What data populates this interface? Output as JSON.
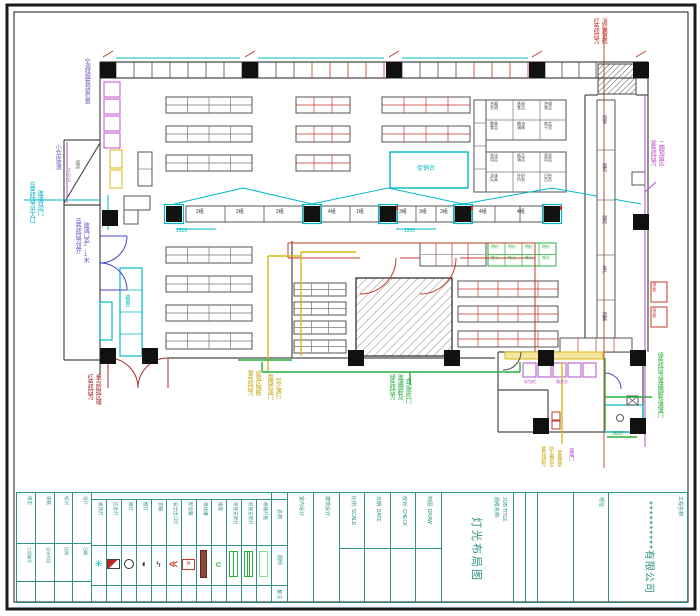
{
  "title_block": {
    "company": {
      "project_label": "工程名称:",
      "name": "**********有限公司"
    },
    "address_label": "地址:",
    "job": {
      "label": "图纸名称:",
      "label_en": "JOB TITLE",
      "title": "灯光布局图"
    },
    "fields": [
      "室内设计",
      "建筑设计",
      "比例: SCALE",
      "日期: DATE",
      "校对: CHECK",
      "制图: DRAW"
    ],
    "sign_table": {
      "cols": [
        {
          "top": "审定",
          "mid": "工程编号"
        },
        {
          "top": "审核",
          "mid": "设计阶段"
        },
        {
          "top": "校对",
          "mid": "比例"
        },
        {
          "top": "设计",
          "mid": "日期"
        }
      ]
    },
    "legend": {
      "headers": {
        "col_name": "名称",
        "col_symbol": "图例",
        "col_note": "备注"
      },
      "items": [
        {
          "name": "吸顶灯",
          "icon": "ceiling-lamp-icon"
        },
        {
          "name": "应急灯",
          "icon": "emergency-light-icon"
        },
        {
          "name": "筒灯",
          "icon": "downlight-icon"
        },
        {
          "name": "壁灯",
          "icon": "wall-lamp-icon"
        },
        {
          "name": "音箱",
          "icon": "speaker-icon"
        },
        {
          "name": "安全出口灯",
          "icon": "exit-light-icon"
        },
        {
          "name": "配电箱",
          "icon": "distribution-box-icon"
        },
        {
          "name": "母线槽",
          "icon": "busbar-icon"
        },
        {
          "name": "插座",
          "icon": "socket-icon"
        },
        {
          "name": "单管支架灯",
          "icon": "single-tube-light-icon"
        },
        {
          "name": "双管支架灯",
          "icon": "double-tube-light-icon"
        },
        {
          "name": "格栅灯盘",
          "icon": "grille-lamp-icon"
        }
      ]
    }
  },
  "colors": {
    "teal": "#2a9183",
    "cyan": "#00b9c8",
    "red": "#c0392b",
    "dark_red": "#a03030",
    "green": "#27b13c",
    "yellow": "#c9a912",
    "magenta": "#c052c8",
    "purple": "#8060c0",
    "blue": "#4646c8",
    "wall_gray": "#4a4a4a"
  },
  "plan": {
    "labels": [
      {
        "t": "空调排烟管预留位置",
        "x": 83,
        "y": 58,
        "c": "#8060c0",
        "s": 6,
        "o": "v"
      },
      {
        "t": "小仓库坡道",
        "x": 54,
        "y": 144,
        "c": "#8060c0",
        "s": 6,
        "o": "v"
      },
      {
        "t": "蓝色线段为出入口",
        "x": 28,
        "y": 182,
        "c": "#00b9c8",
        "s": 6,
        "o": "v"
      },
      {
        "t": "玻璃自动门",
        "x": 36,
        "y": 190,
        "c": "#00b9c8",
        "s": 6,
        "o": "v"
      },
      {
        "t": "蓝色线段为双开",
        "x": 74,
        "y": 218,
        "c": "#6a5acd",
        "s": 6,
        "o": "v"
      },
      {
        "t": "玻璃门宽2.1米",
        "x": 82,
        "y": 222,
        "c": "#6a5acd",
        "s": 6,
        "o": "v"
      },
      {
        "t": "红色线段为",
        "x": 86,
        "y": 374,
        "c": "#a03030",
        "s": 6,
        "o": "v"
      },
      {
        "t": "重点防损区域",
        "x": 94,
        "y": 374,
        "c": "#a03030",
        "s": 6,
        "o": "v"
      },
      {
        "t": "黄色线段为",
        "x": 246,
        "y": 370,
        "c": "#c9a912",
        "s": 6,
        "o": "v"
      },
      {
        "t": "收银区隔断",
        "x": 254,
        "y": 370,
        "c": "#c9a912",
        "s": 6,
        "o": "v"
      },
      {
        "t": "需做防盗门",
        "x": 266,
        "y": 374,
        "c": "#c9a912",
        "s": 6,
        "o": "v"
      },
      {
        "t": "禁止通行",
        "x": 274,
        "y": 378,
        "c": "#c9a912",
        "s": 6,
        "o": "v"
      },
      {
        "t": "绿色线段为",
        "x": 388,
        "y": 374,
        "c": "#27b13c",
        "s": 6,
        "o": "v"
      },
      {
        "t": "玻璃隔断及",
        "x": 396,
        "y": 374,
        "c": "#27b13c",
        "s": 6,
        "o": "v"
      },
      {
        "t": "自动感应门",
        "x": 404,
        "y": 378,
        "c": "#27b13c",
        "s": 6,
        "o": "v"
      },
      {
        "t": "红色线段为",
        "x": 592,
        "y": 18,
        "c": "#c0392b",
        "s": 6,
        "o": "v"
      },
      {
        "t": "消防通道线",
        "x": 600,
        "y": 18,
        "c": "#c0392b",
        "s": 6,
        "o": "v"
      },
      {
        "t": "紫色线段为",
        "x": 649,
        "y": 140,
        "c": "#c052c8",
        "s": 6,
        "o": "v"
      },
      {
        "t": "二期预留区",
        "x": 657,
        "y": 140,
        "c": "#c052c8",
        "s": 6,
        "o": "v"
      },
      {
        "t": "绿色线段为玻璃隔断及通道门",
        "x": 656,
        "y": 352,
        "c": "#27b13c",
        "s": 6,
        "o": "v"
      },
      {
        "t": "黄色线段为",
        "x": 540,
        "y": 446,
        "c": "#c9a912",
        "s": 5,
        "o": "v"
      },
      {
        "t": "防火卷帘位",
        "x": 548,
        "y": 446,
        "c": "#c9a912",
        "s": 5,
        "o": "v"
      },
      {
        "t": "置需预留",
        "x": 556,
        "y": 450,
        "c": "#c9a912",
        "s": 5,
        "o": "v"
      },
      {
        "t": "玻璃门",
        "x": 568,
        "y": 448,
        "c": "#c052c8",
        "s": 5,
        "o": "v"
      },
      {
        "t": "1500",
        "x": 176,
        "y": 229,
        "c": "#00b9c8",
        "s": 5,
        "o": "h"
      },
      {
        "t": "1500",
        "x": 404,
        "y": 229,
        "c": "#00b9c8",
        "s": 5,
        "o": "h"
      },
      {
        "t": "3600",
        "x": 612,
        "y": 432,
        "c": "#27b13c",
        "s": 5,
        "o": "h"
      },
      {
        "t": "200",
        "x": 66,
        "y": 168,
        "c": "#888888",
        "s": 5,
        "o": "v"
      },
      {
        "t": "2组",
        "x": 196,
        "y": 210,
        "c": "#333333",
        "s": 5,
        "o": "h"
      },
      {
        "t": "2组",
        "x": 236,
        "y": 210,
        "c": "#333333",
        "s": 5,
        "o": "h"
      },
      {
        "t": "2组",
        "x": 276,
        "y": 210,
        "c": "#333333",
        "s": 5,
        "o": "h"
      },
      {
        "t": "4组",
        "x": 328,
        "y": 210,
        "c": "#333333",
        "s": 5,
        "o": "h"
      },
      {
        "t": "1组",
        "x": 356,
        "y": 210,
        "c": "#333333",
        "s": 5,
        "o": "h"
      },
      {
        "t": "3组",
        "x": 399,
        "y": 210,
        "c": "#333333",
        "s": 5,
        "o": "h"
      },
      {
        "t": "3组",
        "x": 419,
        "y": 210,
        "c": "#333333",
        "s": 5,
        "o": "h"
      },
      {
        "t": "3组",
        "x": 440,
        "y": 210,
        "c": "#333333",
        "s": 5,
        "o": "h"
      },
      {
        "t": "4组",
        "x": 479,
        "y": 210,
        "c": "#333333",
        "s": 5,
        "o": "h"
      },
      {
        "t": "4组",
        "x": 517,
        "y": 210,
        "c": "#333333",
        "s": 5,
        "o": "h"
      },
      {
        "t": "名烟\n名酒",
        "x": 490,
        "y": 102,
        "c": "#444444",
        "s": 4,
        "o": "h"
      },
      {
        "t": "休闲\n食品",
        "x": 517,
        "y": 102,
        "c": "#444444",
        "s": 4,
        "o": "h"
      },
      {
        "t": "冲调\n食品",
        "x": 544,
        "y": 102,
        "c": "#444444",
        "s": 4,
        "o": "h"
      },
      {
        "t": "散装\n食品",
        "x": 490,
        "y": 122,
        "c": "#444444",
        "s": 4,
        "o": "h"
      },
      {
        "t": "粮油\n调味",
        "x": 517,
        "y": 122,
        "c": "#444444",
        "s": 4,
        "o": "h"
      },
      {
        "t": "南北\n干货",
        "x": 544,
        "y": 122,
        "c": "#444444",
        "s": 4,
        "o": "h"
      },
      {
        "t": "洗化\n用品",
        "x": 490,
        "y": 154,
        "c": "#444444",
        "s": 4,
        "o": "h"
      },
      {
        "t": "纸品\n清洁",
        "x": 517,
        "y": 154,
        "c": "#444444",
        "s": 4,
        "o": "h"
      },
      {
        "t": "家居\n用品",
        "x": 544,
        "y": 154,
        "c": "#444444",
        "s": 4,
        "o": "h"
      },
      {
        "t": "文体\n玩具",
        "x": 490,
        "y": 174,
        "c": "#444444",
        "s": 4,
        "o": "h"
      },
      {
        "t": "针织\n内衣",
        "x": 517,
        "y": 174,
        "c": "#444444",
        "s": 4,
        "o": "h"
      },
      {
        "t": "日杂\n百货",
        "x": 544,
        "y": 174,
        "c": "#444444",
        "s": 4,
        "o": "h"
      },
      {
        "t": "熟食",
        "x": 601,
        "y": 115,
        "c": "#555555",
        "s": 5,
        "o": "v"
      },
      {
        "t": "面点",
        "x": 601,
        "y": 163,
        "c": "#555555",
        "s": 5,
        "o": "v"
      },
      {
        "t": "鲜肉",
        "x": 601,
        "y": 215,
        "c": "#555555",
        "s": 5,
        "o": "v"
      },
      {
        "t": "水产",
        "x": 601,
        "y": 265,
        "c": "#555555",
        "s": 5,
        "o": "v"
      },
      {
        "t": "蔬果",
        "x": 601,
        "y": 312,
        "c": "#555555",
        "s": 5,
        "o": "v"
      },
      {
        "t": "促销台",
        "x": 417,
        "y": 166,
        "c": "#00b9c8",
        "s": 6,
        "o": "h"
      },
      {
        "t": "特价",
        "x": 491,
        "y": 245,
        "c": "#27b13c",
        "s": 4,
        "o": "h"
      },
      {
        "t": "特价",
        "x": 508,
        "y": 245,
        "c": "#27b13c",
        "s": 4,
        "o": "h"
      },
      {
        "t": "特价",
        "x": 525,
        "y": 245,
        "c": "#27b13c",
        "s": 4,
        "o": "h"
      },
      {
        "t": "特价",
        "x": 542,
        "y": 245,
        "c": "#27b13c",
        "s": 4,
        "o": "h"
      },
      {
        "t": "堆头",
        "x": 491,
        "y": 256,
        "c": "#27b13c",
        "s": 4,
        "o": "h"
      },
      {
        "t": "堆头",
        "x": 508,
        "y": 256,
        "c": "#27b13c",
        "s": 4,
        "o": "h"
      },
      {
        "t": "堆头",
        "x": 525,
        "y": 256,
        "c": "#27b13c",
        "s": 4,
        "o": "h"
      },
      {
        "t": "堆头",
        "x": 542,
        "y": 256,
        "c": "#27b13c",
        "s": 4,
        "o": "h"
      },
      {
        "t": "消火栓",
        "x": 652,
        "y": 282,
        "c": "#c0392b",
        "s": 4,
        "o": "v"
      },
      {
        "t": "消火栓",
        "x": 652,
        "y": 308,
        "c": "#c0392b",
        "s": 4,
        "o": "v"
      },
      {
        "t": "收银台",
        "x": 124,
        "y": 294,
        "c": "#00b9c8",
        "s": 5,
        "o": "v"
      },
      {
        "t": "坡道",
        "x": 74,
        "y": 160,
        "c": "#777777",
        "s": 5,
        "o": "v"
      },
      {
        "t": "存包柜",
        "x": 524,
        "y": 380,
        "c": "#b050c8",
        "s": 4,
        "o": "h"
      },
      {
        "t": "服务台",
        "x": 556,
        "y": 380,
        "c": "#b050c8",
        "s": 4,
        "o": "h"
      }
    ]
  }
}
